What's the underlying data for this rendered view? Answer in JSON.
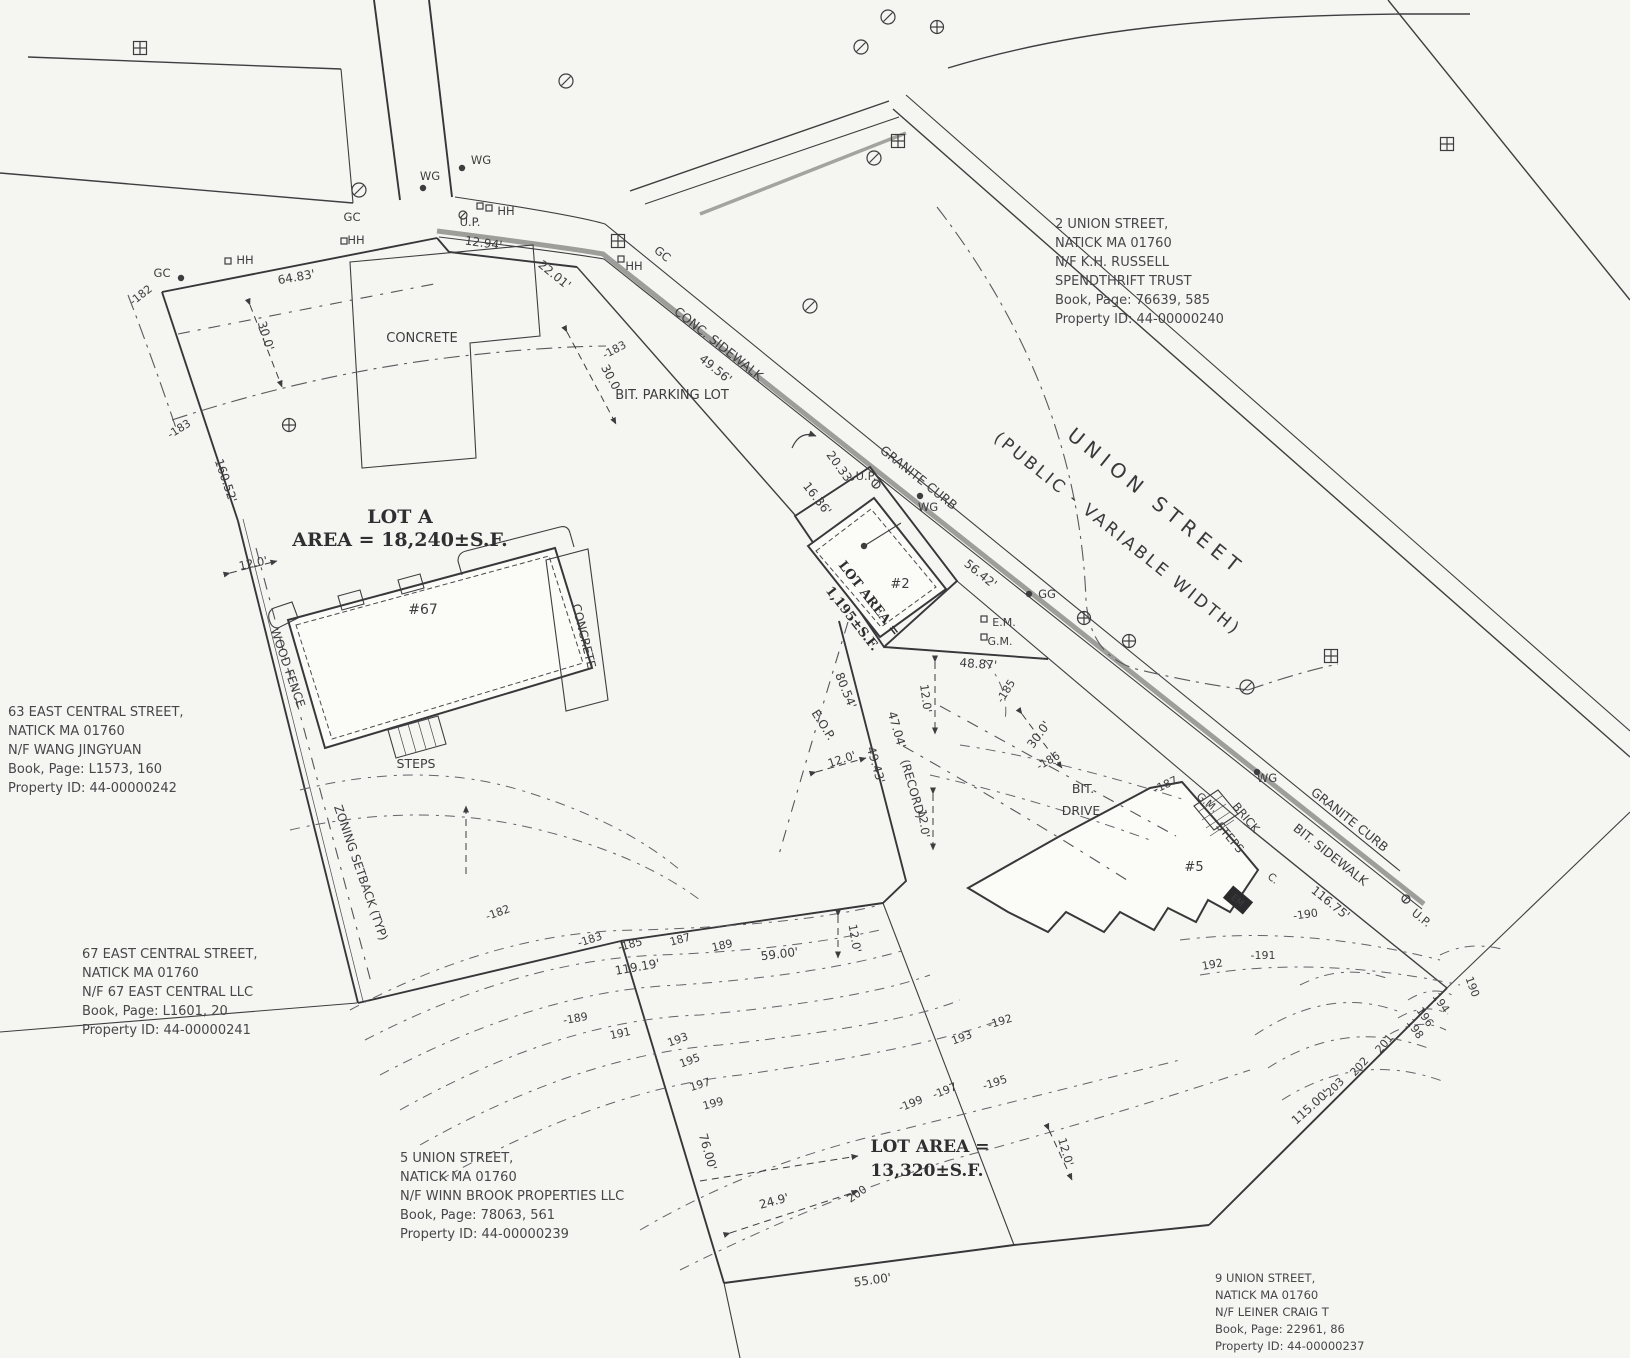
{
  "page": {
    "background": "#f5f5f2",
    "ink": "#3d3d3f",
    "curb_gray": "#9d9d9a"
  },
  "drawing": {
    "street_label": {
      "r": 39,
      "lines": [
        {
          "t": "UNION STREET",
          "x": 1152,
          "y": 507,
          "s": 20,
          "ls": 6
        },
        {
          "t": "(PUBLIC - VARIABLE WIDTH)",
          "x": 1114,
          "y": 538,
          "s": 17,
          "ls": 3
        }
      ]
    },
    "parcel_notes": [
      {
        "id": "parcel-note-2-union",
        "x": 1055,
        "y": 228,
        "s": 13,
        "lh": 19,
        "lines": [
          "2 UNION STREET,",
          "NATICK MA 01760",
          "N/F K.H. RUSSELL",
          "SPENDTHRIFT TRUST",
          "Book, Page: 76639, 585",
          "Property ID: 44-00000240"
        ]
      },
      {
        "id": "parcel-note-63-east-central",
        "x": 8,
        "y": 716,
        "s": 13,
        "lh": 19,
        "lines": [
          "63 EAST CENTRAL STREET,",
          "NATICK MA 01760",
          "N/F  WANG JINGYUAN",
          "Book, Page: L1573, 160",
          "Property ID: 44-00000242"
        ]
      },
      {
        "id": "parcel-note-67-east-central",
        "x": 82,
        "y": 958,
        "s": 13,
        "lh": 19,
        "lines": [
          "67 EAST CENTRAL STREET,",
          "NATICK MA 01760",
          "N/F 67 EAST CENTRAL LLC",
          "Book, Page: L1601, 20",
          "Property ID: 44-00000241"
        ]
      },
      {
        "id": "parcel-note-5-union",
        "x": 400,
        "y": 1162,
        "s": 13,
        "lh": 19,
        "lines": [
          "5 UNION STREET,",
          "NATICK MA 01760",
          "N/F WINN BROOK PROPERTIES LLC",
          "Book, Page: 78063, 561",
          "Property ID: 44-00000239"
        ]
      },
      {
        "id": "parcel-note-9-union",
        "x": 1215,
        "y": 1282,
        "s": 11.5,
        "lh": 17,
        "lines": [
          "9 UNION STREET,",
          "NATICK MA 01760",
          "N/F LEINER CRAIG T",
          "Book, Page: 22961, 86",
          "Property ID: 44-00000237"
        ]
      }
    ],
    "lot_labels": [
      {
        "id": "lot-a-label",
        "r": 0,
        "lines": [
          {
            "t": "LOT A",
            "x": 400,
            "y": 523,
            "s": 19
          },
          {
            "t": "AREA = 18,240±S.F.",
            "x": 400,
            "y": 546,
            "s": 19
          }
        ]
      },
      {
        "id": "lot-2-label",
        "r": 52,
        "lines": [
          {
            "t": "LOT AREA =",
            "x": 866,
            "y": 601,
            "s": 13
          },
          {
            "t": "1,195±S.F.",
            "x": 849,
            "y": 621,
            "s": 13
          }
        ]
      },
      {
        "id": "lot-5-label",
        "r": 0,
        "lines": [
          {
            "t": "LOT AREA =",
            "x": 930,
            "y": 1152,
            "s": 17
          },
          {
            "t": "13,320±S.F.",
            "x": 927,
            "y": 1176,
            "s": 17
          }
        ]
      }
    ],
    "annotations": [
      {
        "t": "CONCRETE",
        "x": 422,
        "y": 342,
        "s": 13
      },
      {
        "t": "CONC. SIDEWALK",
        "x": 716,
        "y": 347,
        "r": 38.5,
        "s": 12.5
      },
      {
        "t": "BIT. PARKING LOT",
        "x": 672,
        "y": 399,
        "s": 13
      },
      {
        "t": "GRANITE CURB",
        "x": 916,
        "y": 481,
        "r": 38.5,
        "s": 12.5
      },
      {
        "t": "GRANITE CURB",
        "x": 1347,
        "y": 823,
        "r": 38.5,
        "s": 12.5
      },
      {
        "t": "BIT. SIDEWALK",
        "x": 1328,
        "y": 858,
        "r": 38.5,
        "s": 12.5
      },
      {
        "t": "BIT.",
        "x": 1083,
        "y": 793,
        "s": 12.5
      },
      {
        "t": "DRIVE",
        "x": 1081,
        "y": 815,
        "s": 12.5
      },
      {
        "t": "WOOD FENCE",
        "x": 284,
        "y": 669,
        "r": 71,
        "s": 12
      },
      {
        "t": "CONCRETE",
        "x": 580,
        "y": 637,
        "r": 76,
        "s": 12
      },
      {
        "t": "ZONING SETBACK (TYP)",
        "x": 357,
        "y": 874,
        "r": 71,
        "s": 12
      },
      {
        "t": "STEPS",
        "x": 416,
        "y": 768,
        "s": 12.5
      },
      {
        "t": "BRICK",
        "x": 1243,
        "y": 820,
        "r": 50,
        "s": 11.5
      },
      {
        "t": "STEPS",
        "x": 1227,
        "y": 840,
        "r": 50,
        "s": 11.5
      },
      {
        "t": "E.O.P.",
        "x": 820,
        "y": 727,
        "r": 58,
        "s": 12
      },
      {
        "t": "#67",
        "x": 423,
        "y": 614,
        "s": 14
      },
      {
        "t": "#2",
        "x": 900,
        "y": 588,
        "s": 13
      },
      {
        "t": "#5",
        "x": 1194,
        "y": 871,
        "s": 13
      },
      {
        "t": "U.P.",
        "x": 470,
        "y": 226,
        "s": 11.5
      },
      {
        "t": "U.P.",
        "x": 866,
        "y": 480,
        "s": 11.5
      },
      {
        "t": "U.P.",
        "x": 1419,
        "y": 921,
        "r": 39,
        "s": 11.5
      },
      {
        "t": "WG",
        "x": 481,
        "y": 164,
        "s": 11.5
      },
      {
        "t": "WG",
        "x": 430,
        "y": 180,
        "s": 11.5
      },
      {
        "t": "WG",
        "x": 928,
        "y": 511,
        "s": 11.5
      },
      {
        "t": "WG",
        "x": 1267,
        "y": 782,
        "s": 11.5
      },
      {
        "t": "HH",
        "x": 245,
        "y": 264,
        "s": 11.5
      },
      {
        "t": "HH",
        "x": 356,
        "y": 244,
        "s": 11.5
      },
      {
        "t": "HH",
        "x": 506,
        "y": 215,
        "s": 11.5
      },
      {
        "t": "HH",
        "x": 634,
        "y": 270,
        "s": 11.5
      },
      {
        "t": "GC",
        "x": 162,
        "y": 277,
        "s": 11.5
      },
      {
        "t": "GC",
        "x": 352,
        "y": 221,
        "s": 11.5
      },
      {
        "t": "GC",
        "x": 660,
        "y": 257,
        "r": 39,
        "s": 11.5
      },
      {
        "t": "GG",
        "x": 1047,
        "y": 598,
        "s": 11.5
      },
      {
        "t": "E.M.",
        "x": 1004,
        "y": 626,
        "s": 11
      },
      {
        "t": "G.M.",
        "x": 1000,
        "y": 645,
        "s": 11
      },
      {
        "t": "G.M.",
        "x": 1205,
        "y": 805,
        "r": 40,
        "s": 10.5
      },
      {
        "t": "C.",
        "x": 1271,
        "y": 881,
        "r": 40,
        "s": 10.5
      },
      {
        "t": "64.83'",
        "x": 297,
        "y": 281,
        "r": -10,
        "s": 12
      },
      {
        "t": "12.94'",
        "x": 483,
        "y": 247,
        "r": 8,
        "s": 12
      },
      {
        "t": "22.01'",
        "x": 552,
        "y": 278,
        "r": 39,
        "s": 12
      },
      {
        "t": "49.56'",
        "x": 713,
        "y": 372,
        "r": 39,
        "s": 12
      },
      {
        "t": "20.33'",
        "x": 837,
        "y": 470,
        "r": 54,
        "s": 12
      },
      {
        "t": "16.36'",
        "x": 814,
        "y": 501,
        "r": 52,
        "s": 12
      },
      {
        "t": "56.42'",
        "x": 978,
        "y": 577,
        "r": 39,
        "s": 12
      },
      {
        "t": "48.87'",
        "x": 978,
        "y": 668,
        "r": 4,
        "s": 12
      },
      {
        "t": "80.54'",
        "x": 842,
        "y": 692,
        "r": 68,
        "s": 12
      },
      {
        "t": "47.04'",
        "x": 893,
        "y": 731,
        "r": 74,
        "s": 12
      },
      {
        "t": "(RECORD)",
        "x": 909,
        "y": 790,
        "r": 74,
        "s": 12
      },
      {
        "t": "49.43'",
        "x": 872,
        "y": 766,
        "r": 74,
        "s": 12
      },
      {
        "t": "160.52'",
        "x": 222,
        "y": 482,
        "r": 71,
        "s": 12
      },
      {
        "t": "119.19'",
        "x": 638,
        "y": 971,
        "r": -10,
        "s": 12
      },
      {
        "t": "59.00'",
        "x": 780,
        "y": 958,
        "r": -7,
        "s": 12
      },
      {
        "t": "76.00'",
        "x": 704,
        "y": 1153,
        "r": 74,
        "s": 12
      },
      {
        "t": "24.9'",
        "x": 775,
        "y": 1205,
        "r": -15,
        "s": 12
      },
      {
        "t": "55.00'",
        "x": 873,
        "y": 1284,
        "r": -8,
        "s": 12
      },
      {
        "t": "115.00'",
        "x": 1313,
        "y": 1110,
        "r": -42,
        "s": 12
      },
      {
        "t": "116.75'",
        "x": 1328,
        "y": 906,
        "r": 39,
        "s": 12
      },
      {
        "t": "30.0'",
        "x": 262,
        "y": 337,
        "r": 73,
        "s": 12
      },
      {
        "t": "30.0",
        "x": 607,
        "y": 379,
        "r": 62,
        "s": 12
      },
      {
        "t": "30.0'",
        "x": 1042,
        "y": 737,
        "r": -54,
        "s": 12
      },
      {
        "t": "12.0'",
        "x": 254,
        "y": 567,
        "r": -12,
        "s": 11.5
      },
      {
        "t": "12.0'",
        "x": 922,
        "y": 699,
        "r": 82,
        "s": 11.5
      },
      {
        "t": "12.0'",
        "x": 920,
        "y": 824,
        "r": 82,
        "s": 11.5
      },
      {
        "t": "12.0'",
        "x": 851,
        "y": 939,
        "r": 80,
        "s": 11.5
      },
      {
        "t": "12.0'",
        "x": 843,
        "y": 763,
        "r": -18,
        "s": 11.5
      },
      {
        "t": "12.0'",
        "x": 1062,
        "y": 1153,
        "r": 74,
        "s": 11.5
      },
      {
        "t": "-182",
        "x": 143,
        "y": 298,
        "r": -38,
        "s": 11
      },
      {
        "t": "-183",
        "x": 181,
        "y": 432,
        "r": -32,
        "s": 11
      },
      {
        "t": "-183",
        "x": 616,
        "y": 353,
        "r": -28,
        "s": 11
      },
      {
        "t": "-182",
        "x": 499,
        "y": 916,
        "r": -20,
        "s": 11
      },
      {
        "t": "-183",
        "x": 591,
        "y": 943,
        "r": -18,
        "s": 11
      },
      {
        "t": "-185",
        "x": 631,
        "y": 948,
        "r": -15,
        "s": 11
      },
      {
        "t": "187",
        "x": 681,
        "y": 943,
        "r": -15,
        "s": 11
      },
      {
        "t": "189",
        "x": 723,
        "y": 949,
        "r": -13,
        "s": 11
      },
      {
        "t": "-189",
        "x": 576,
        "y": 1022,
        "r": -10,
        "s": 11
      },
      {
        "t": "191",
        "x": 621,
        "y": 1037,
        "r": -12,
        "s": 11
      },
      {
        "t": "193",
        "x": 679,
        "y": 1043,
        "r": -20,
        "s": 11
      },
      {
        "t": "195",
        "x": 691,
        "y": 1064,
        "r": -20,
        "s": 11
      },
      {
        "t": "197",
        "x": 701,
        "y": 1088,
        "r": -17,
        "s": 11
      },
      {
        "t": "199",
        "x": 714,
        "y": 1107,
        "r": -15,
        "s": 11
      },
      {
        "t": "-185",
        "x": 1009,
        "y": 693,
        "r": -58,
        "s": 11
      },
      {
        "t": "-186",
        "x": 1050,
        "y": 764,
        "r": -30,
        "s": 11
      },
      {
        "t": "-187",
        "x": 1167,
        "y": 788,
        "r": -25,
        "s": 11
      },
      {
        "t": "-190",
        "x": 1306,
        "y": 918,
        "r": -8,
        "s": 11
      },
      {
        "t": "-191",
        "x": 1263,
        "y": 959,
        "r": 0,
        "s": 11
      },
      {
        "t": "-192",
        "x": 1001,
        "y": 1025,
        "r": -17,
        "s": 11
      },
      {
        "t": "193",
        "x": 963,
        "y": 1041,
        "r": -20,
        "s": 11
      },
      {
        "t": "-195",
        "x": 996,
        "y": 1086,
        "r": -18,
        "s": 11
      },
      {
        "t": "-197",
        "x": 946,
        "y": 1094,
        "r": -22,
        "s": 11
      },
      {
        "t": "-199",
        "x": 912,
        "y": 1107,
        "r": -22,
        "s": 11
      },
      {
        "t": "200",
        "x": 859,
        "y": 1197,
        "r": -35,
        "s": 11
      },
      {
        "t": "190",
        "x": 1469,
        "y": 988,
        "r": 70,
        "s": 11
      },
      {
        "t": "194",
        "x": 1438,
        "y": 1005,
        "r": 55,
        "s": 11
      },
      {
        "t": "196",
        "x": 1422,
        "y": 1019,
        "r": 55,
        "s": 11
      },
      {
        "t": "198",
        "x": 1412,
        "y": 1031,
        "r": 55,
        "s": 11
      },
      {
        "t": "201",
        "x": 1387,
        "y": 1046,
        "r": -50,
        "s": 11
      },
      {
        "t": "202",
        "x": 1362,
        "y": 1069,
        "r": -48,
        "s": 11
      },
      {
        "t": "-203",
        "x": 1336,
        "y": 1091,
        "r": -45,
        "s": 11
      },
      {
        "t": "192",
        "x": 1213,
        "y": 968,
        "r": -10,
        "s": 11
      }
    ],
    "symbols": [
      {
        "k": "circle-slash",
        "x": 888,
        "y": 17
      },
      {
        "k": "circle-slash",
        "x": 861,
        "y": 47
      },
      {
        "k": "circle-slash",
        "x": 566,
        "y": 81
      },
      {
        "k": "circle-slash",
        "x": 359,
        "y": 190
      },
      {
        "k": "circle-slash",
        "x": 810,
        "y": 306
      },
      {
        "k": "circle-slash",
        "x": 874,
        "y": 158
      },
      {
        "k": "circle-slash",
        "x": 1247,
        "y": 687
      },
      {
        "k": "circle-plus",
        "x": 937,
        "y": 27
      },
      {
        "k": "circle-plus",
        "x": 289,
        "y": 425
      },
      {
        "k": "circle-plus",
        "x": 1084,
        "y": 618
      },
      {
        "k": "circle-plus",
        "x": 1129,
        "y": 641
      },
      {
        "k": "square-plus",
        "x": 140,
        "y": 48
      },
      {
        "k": "square-plus",
        "x": 898,
        "y": 141
      },
      {
        "k": "square-plus",
        "x": 618,
        "y": 241
      },
      {
        "k": "square-plus",
        "x": 1447,
        "y": 144
      },
      {
        "k": "square-plus",
        "x": 1331,
        "y": 656
      },
      {
        "k": "dot",
        "x": 462,
        "y": 168
      },
      {
        "k": "dot",
        "x": 423,
        "y": 188
      },
      {
        "k": "dot",
        "x": 920,
        "y": 496
      },
      {
        "k": "dot",
        "x": 1029,
        "y": 594
      },
      {
        "k": "dot",
        "x": 1257,
        "y": 772
      },
      {
        "k": "dot",
        "x": 181,
        "y": 278
      },
      {
        "k": "dot",
        "x": 864,
        "y": 546
      },
      {
        "k": "pole",
        "x": 463,
        "y": 215
      },
      {
        "k": "pole",
        "x": 876,
        "y": 484
      },
      {
        "k": "pole",
        "x": 1406,
        "y": 899
      },
      {
        "k": "sq",
        "x": 228,
        "y": 261
      },
      {
        "k": "sq",
        "x": 344,
        "y": 241
      },
      {
        "k": "sq",
        "x": 480,
        "y": 206
      },
      {
        "k": "sq",
        "x": 489,
        "y": 208
      },
      {
        "k": "sq",
        "x": 621,
        "y": 259
      },
      {
        "k": "sq",
        "x": 984,
        "y": 619
      },
      {
        "k": "sq",
        "x": 984,
        "y": 637
      },
      {
        "k": "em-box",
        "x": 1238,
        "y": 900,
        "r": 40,
        "t": "EM"
      }
    ]
  }
}
